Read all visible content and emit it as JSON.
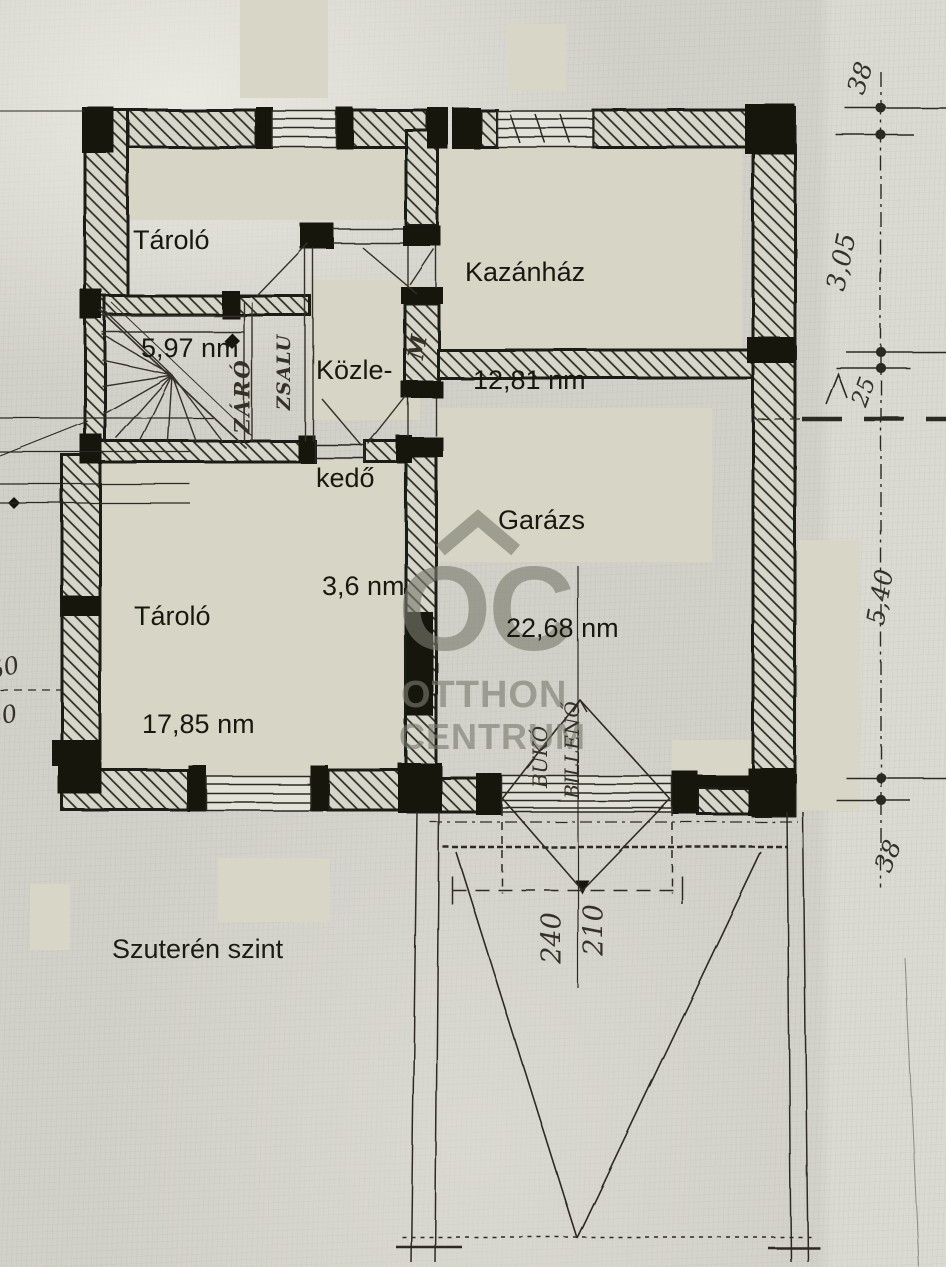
{
  "level_label": "Szuterén szint",
  "rooms": [
    {
      "name": "Tároló",
      "area": "5,97 nm"
    },
    {
      "name": "Kazánház",
      "area": "12,81 nm"
    },
    {
      "name_line1": "Közle-",
      "name_line2": "kedő",
      "area": "3,6 nm"
    },
    {
      "name": "Garázs",
      "area": "22,68 nm"
    },
    {
      "name": "Tároló",
      "area": "17,85 nm"
    }
  ],
  "dimensions": {
    "right": [
      "38",
      "3,05",
      "25",
      "5,40",
      "38"
    ],
    "left": [
      "50",
      "50"
    ],
    "garage_door": [
      "240",
      "210"
    ]
  },
  "notes": {
    "garage_door_type": [
      "BUKÓ",
      "BILLENŐ"
    ],
    "stairs": [
      "ZÁRÓ",
      "ZSALU"
    ],
    "wall_mark": "M"
  },
  "watermark": {
    "logo": "OC",
    "line1": "OTTHON",
    "line2": "CENTRUM"
  },
  "colors": {
    "ink": "#1e1d16",
    "paper": "#d5d4cc",
    "patch": "#d7d6c7",
    "watermark_gray": "#8e8e83"
  }
}
